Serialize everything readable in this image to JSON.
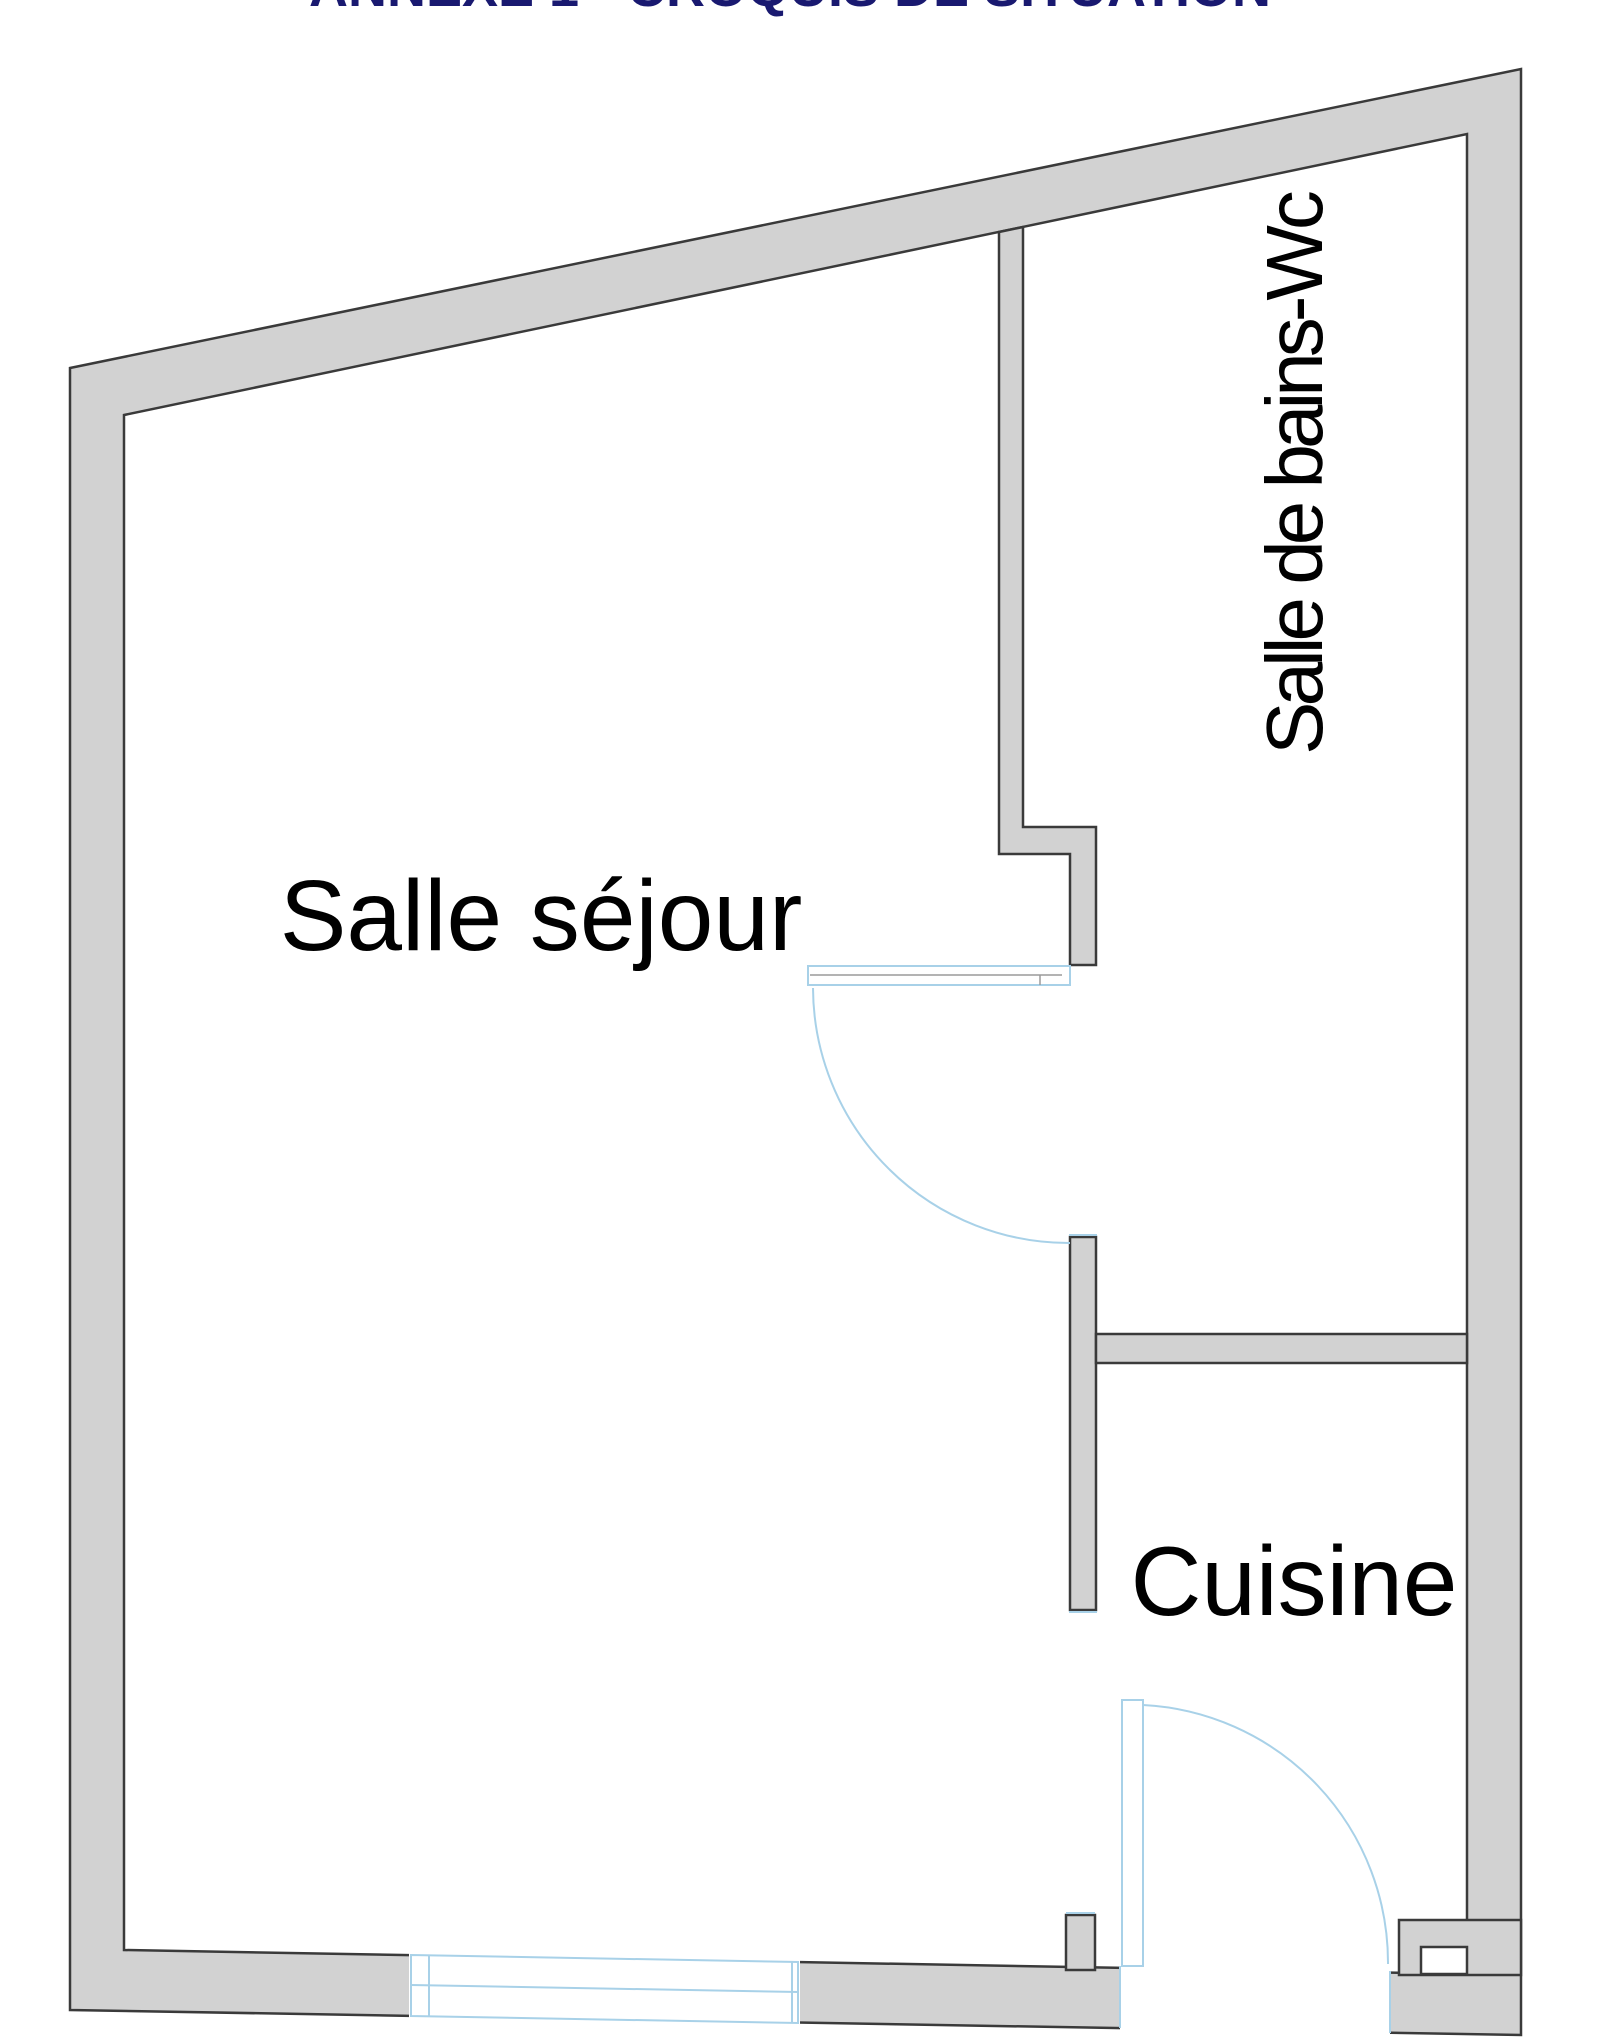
{
  "title": {
    "text": "ANNEXE 1 - CROQUIS DE SITUATION"
  },
  "rooms": {
    "living": {
      "label": "Salle séjour"
    },
    "bathroom": {
      "label": "Salle de bains-Wc"
    },
    "kitchen": {
      "label": "Cuisine"
    }
  },
  "colors": {
    "bg": "#ffffff",
    "wall-fill": "#d2d2d2",
    "wall-outline": "#3a3a3a",
    "door-arc": "#a8d1e8",
    "label": "#000000",
    "title": "#191970"
  }
}
